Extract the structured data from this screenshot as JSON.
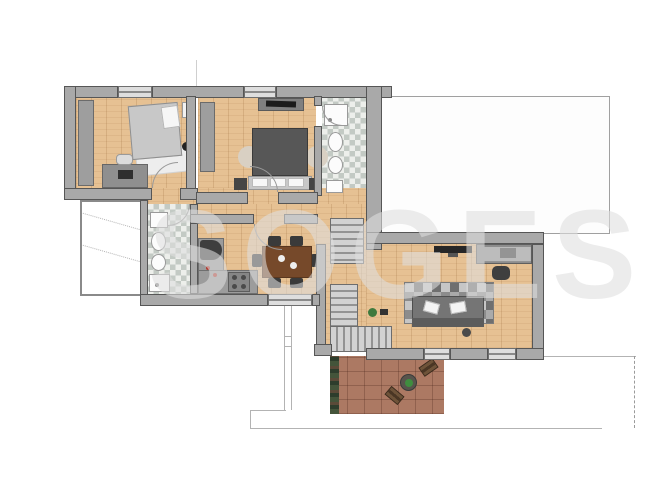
{
  "watermark": {
    "text": "SOGES"
  },
  "plan": {
    "type": "apartment-floor-plan",
    "rooms": [
      {
        "name": "bedroom-1",
        "furniture": [
          "wardrobe",
          "single-bed",
          "pillow",
          "side-table",
          "rug",
          "stool",
          "desk",
          "chair"
        ]
      },
      {
        "name": "bedroom-2",
        "furniture": [
          "wardrobe",
          "double-bed",
          "headboard-pillows",
          "nightstand-left",
          "nightstand-right",
          "round-rug-left",
          "round-rug-right",
          "tv-unit"
        ]
      },
      {
        "name": "bathroom-1",
        "furniture": [
          "shower",
          "toilet",
          "bidet",
          "sink"
        ]
      },
      {
        "name": "bathroom-2",
        "furniture": [
          "sink",
          "toilet",
          "bidet",
          "shower"
        ]
      },
      {
        "name": "hallway",
        "furniture": []
      },
      {
        "name": "kitchen",
        "furniture": [
          "fridge",
          "counter",
          "stove"
        ]
      },
      {
        "name": "dining-area",
        "furniture": [
          "dining-table",
          "chairs-x6",
          "plates"
        ]
      },
      {
        "name": "stair-hall",
        "furniture": [
          "staircase-upper",
          "staircase-lower-L"
        ]
      },
      {
        "name": "living-room",
        "furniture": [
          "wall-tv",
          "desk",
          "office-chair",
          "geometric-rug",
          "sofa",
          "white-pillows",
          "plant",
          "side-table"
        ]
      },
      {
        "name": "terrace",
        "furniture": [
          "planter-strip",
          "round-table",
          "plant",
          "lounge-chair",
          "lounge-chair"
        ]
      },
      {
        "name": "adjacent-unheated-space",
        "furniture": []
      }
    ]
  },
  "colors": {
    "wall": "#a9a9a9",
    "wall_outline": "#565656",
    "wood_floor": "#e6c193",
    "tile_light": "#edefeb",
    "tile_dark": "#c3cac4",
    "terrace_brick": "#ac7963",
    "sofa": "#757575",
    "duvet": "#575757",
    "dining_table": "#76492a",
    "plant_green": "#3f8d3f",
    "watermark_gray": "#dedede"
  }
}
